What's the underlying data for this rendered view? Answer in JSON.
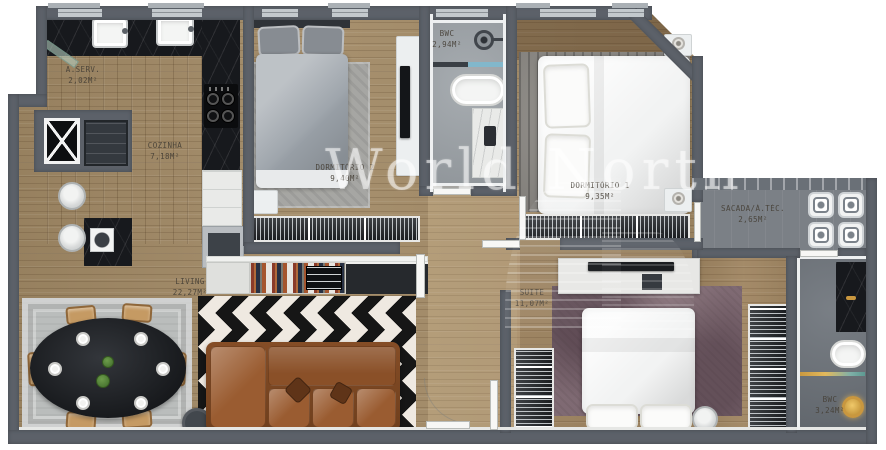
{
  "watermark": {
    "text": "World North"
  },
  "palette": {
    "wall": "#5c6169",
    "wood": "#a28a66",
    "concrete": "#7b8086",
    "bath_light": "#9ba1a6",
    "bath_dark": "#6e747b",
    "marble": "#17191d",
    "sofa": "#9a5c31",
    "chevron_dark": "#161616",
    "chevron_light": "#efe9e1",
    "rug_mauve": "#7f6a73",
    "gold": "#c9973f",
    "watermark": "rgba(255,255,255,0.5)"
  },
  "rooms": {
    "aserv": {
      "name": "A.SERV.",
      "area": "2,02m²"
    },
    "cozinha": {
      "name": "COZINHA",
      "area": "7,18m²"
    },
    "living": {
      "name": "LIVING",
      "area": "22,27m²"
    },
    "dorm2": {
      "name": "DORMITÓRIO 2",
      "area": "9,40m²"
    },
    "bwc_social": {
      "name": "BWC",
      "area": "2,94m²"
    },
    "dorm1": {
      "name": "DORMITÓRIO 1",
      "area": "9,35m²"
    },
    "sacada": {
      "name": "SACADA/Á.TÉC.",
      "area": "2,65m²"
    },
    "suite": {
      "name": "SUITE",
      "area": "11,07m²"
    },
    "bwc_suite": {
      "name": "BWC",
      "area": "3,24m²"
    }
  }
}
